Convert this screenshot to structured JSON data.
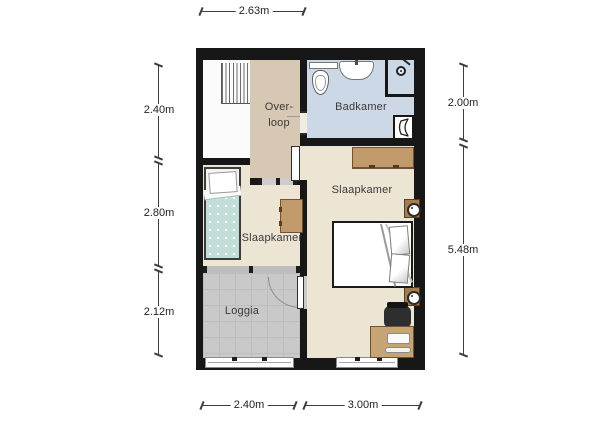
{
  "rooms": {
    "overloop": {
      "line1": "Over-",
      "line2": "loop"
    },
    "badkamer": {
      "label": "Badkamer"
    },
    "slaapkamer_left": {
      "label": "Slaapkamer"
    },
    "slaapkamer_right": {
      "label": "Slaapkamer"
    },
    "loggia": {
      "label": "Loggia"
    }
  },
  "dimensions": {
    "top": {
      "total": "2.63m"
    },
    "bottom": {
      "left": "2.40m",
      "right": "3.00m"
    },
    "left": {
      "top": "2.40m",
      "middle": "2.80m",
      "bottom": "2.12m"
    },
    "right": {
      "top": "2.00m",
      "bottom": "5.48m"
    }
  },
  "fixtures": [
    "stairs-icon",
    "toilet-icon",
    "sink-icon",
    "shower-head-icon",
    "radiator-icon",
    "wardrobe",
    "wall-lamp-icon",
    "double-bed",
    "desk",
    "desk-chair",
    "laptop-icon",
    "single-bed",
    "dresser",
    "window",
    "door"
  ],
  "colors": {
    "wall": "#171717",
    "overloop_floor": "#d7c8b4",
    "bedroom_floor": "#ece5d4",
    "bathroom_floor": "#cdd8e6",
    "loggia_floor": "#c9c9c9",
    "stair_floor": "#fbfbfb",
    "furniture_wood": "#c09a6b",
    "bed_blanket": "#c2ded9"
  }
}
